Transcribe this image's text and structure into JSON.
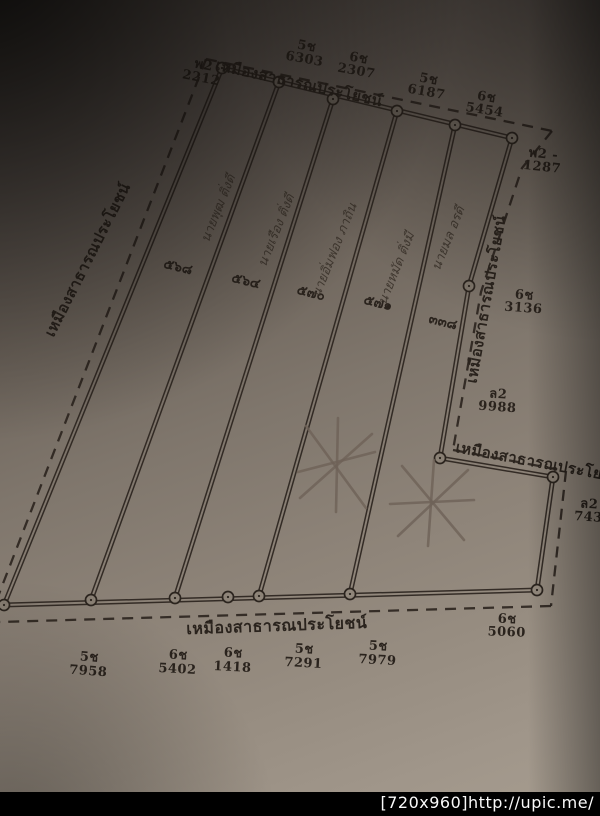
{
  "photo": {
    "watermark": "[720x960]http://upic.me/"
  },
  "map": {
    "ditch_label": "เหมืองสาธารณประโยชน์",
    "plots": [
      {
        "parcel_no": "๕๖๘",
        "owner_name": "นายพุฒ ติ่งดี"
      },
      {
        "parcel_no": "๕๖๔",
        "owner_name": "นายเรือง ติ่งดี"
      },
      {
        "parcel_no": "๕๗๐",
        "owner_name": "นายอิ่มฟอง ภาถิน"
      },
      {
        "parcel_no": "๕๗๑",
        "owner_name": "นายหมัด ติ่งมี"
      },
      {
        "parcel_no": "๓๓๘",
        "owner_name": "นายมล อรดี"
      }
    ],
    "survey_marks": {
      "top": [
        {
          "code": "พ2",
          "number": "2212"
        },
        {
          "code": "5ช",
          "number": "6303"
        },
        {
          "code": "6ช",
          "number": "2307"
        },
        {
          "code": "5ช",
          "number": "6187"
        },
        {
          "code": "6ช",
          "number": "5454"
        }
      ],
      "right": [
        {
          "code": "พ2 -",
          "number": "1287"
        },
        {
          "code": "6ช",
          "number": "3136"
        },
        {
          "code": "ล2",
          "number": "9988"
        },
        {
          "code": "ล2",
          "number": "743"
        }
      ],
      "bottom": [
        {
          "code": "6ช",
          "number": "5060"
        },
        {
          "code": "5ช",
          "number": "7958"
        },
        {
          "code": "6ช",
          "number": "5402"
        },
        {
          "code": "6ช",
          "number": "1418"
        },
        {
          "code": "5ช",
          "number": "7291"
        },
        {
          "code": "5ช",
          "number": "7979"
        }
      ]
    }
  }
}
